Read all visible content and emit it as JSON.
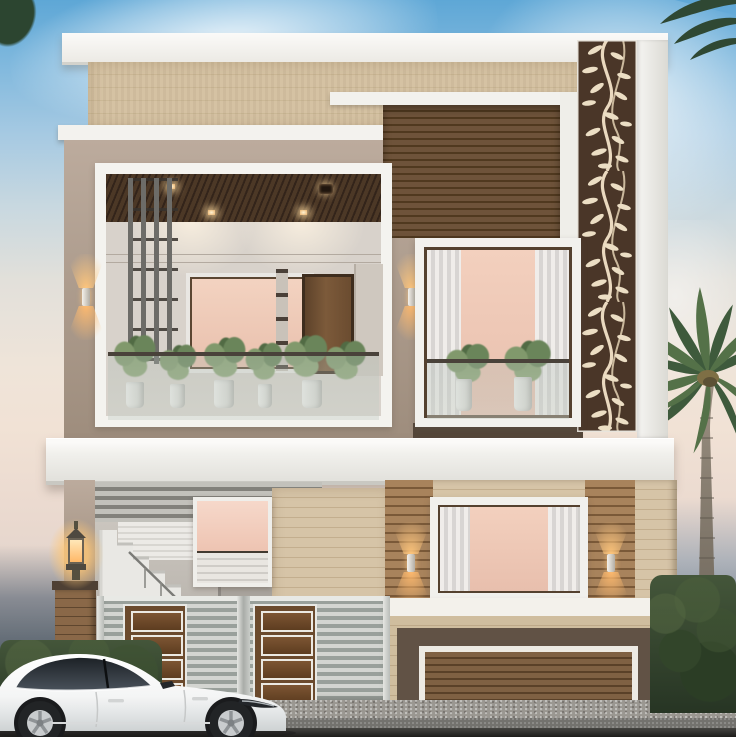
{
  "scene": {
    "description": "3D architectural rendering of a modern two-storey house facade at dusk with a white sedan parked in front, a royal palm on the right, laser-cut floral screen panel, balconies with potted plants, warm sconce lighting, louvered steel gate and wooden garage door",
    "time_of_day": "dusk",
    "weather": "hazy"
  },
  "palette": {
    "sky_top": "#5EA7D6",
    "sky_horizon": "#F1E2D5",
    "roof_white": "#FBFAF8",
    "wall_taupe": "#AB9A8B",
    "plank_beige": "#D5C2A3",
    "slat_dark_wood": "#5C4228",
    "decor_panel_bg": "#4A3628",
    "decor_panel_motif": "#EADCC2",
    "window_peach_glow": "#F0CBB8",
    "sconce_glow": "#FFC67C",
    "gate_steel": "#AEB4AF",
    "gate_wood_panel": "#6B4A2D",
    "garage_wood": "#7F6143",
    "hedge_green": "#35482C",
    "palm_green": "#47633F",
    "car_body": "#FAFBFB",
    "road_asphalt": "#73726E"
  },
  "objects": {
    "house": {
      "storeys": 2,
      "upper_floor": [
        "open balcony with glass railing and potted plants",
        "vertical slat screen",
        "peach lit mirror wall",
        "wood door",
        "curtained bedroom window",
        "dark horizontal slat cladding",
        "floral laser-cut screen column"
      ],
      "ground_floor": [
        "louvered awning",
        "white staircase with railing",
        "lit window",
        "steel double gate with wood inlay panels",
        "pillar lantern",
        "curtained window flanked by sconce-lit wood strips",
        "white parapet",
        "wood slat garage door with dark surround"
      ]
    },
    "vehicle": {
      "type": "white sedan",
      "orientation": "facing right",
      "windows": "tinted"
    },
    "vegetation": [
      "royal palm tree right",
      "hedge row left",
      "shrubs right"
    ],
    "lighting": [
      "4 up/down wall sconces",
      "2 pillar lanterns",
      "recessed ceiling downlights"
    ]
  }
}
